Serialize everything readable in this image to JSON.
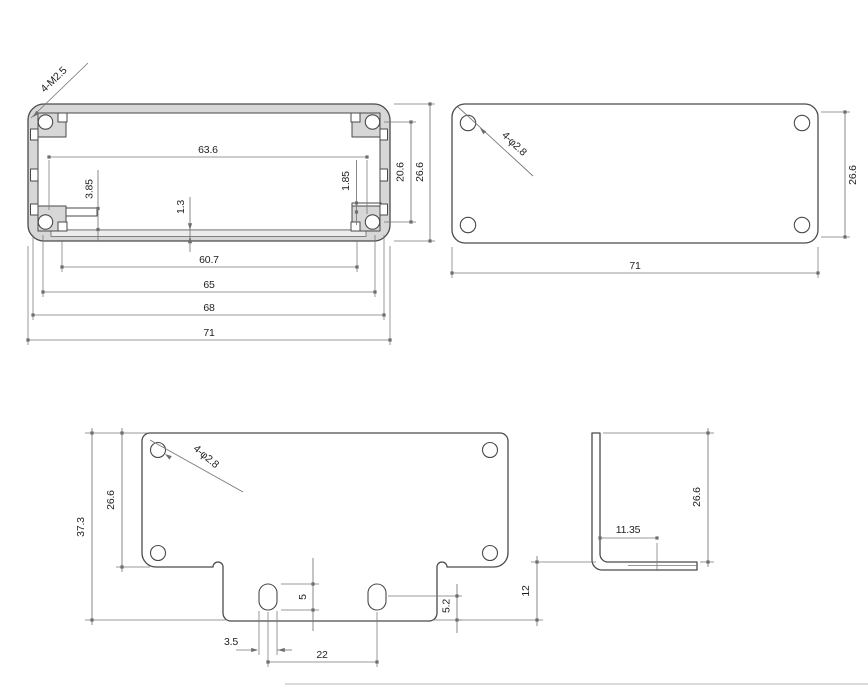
{
  "drawing": {
    "views": {
      "cross_section": {
        "label": "4-M2.5",
        "dims": {
          "inner_width": "63.6",
          "left_rib": "3.85",
          "groove_depth": "1.3",
          "right_rib": "1.85",
          "hole_pitch": "20.6",
          "overall_height": "26.6",
          "slot_span": "60.7",
          "inner_frame_width": "65",
          "boss_span": "68",
          "overall_width": "71"
        }
      },
      "end_plate": {
        "label": "4-φ2.8",
        "dims": {
          "height": "26.6",
          "width": "71"
        }
      },
      "flat_pattern": {
        "label": "4-φ2.8",
        "dims": {
          "overall_height": "37.3",
          "plate_height": "26.6",
          "slot_height": "5",
          "slot_to_edge": "5.2",
          "slot_width": "3.5",
          "slot_pitch": "22"
        }
      },
      "side_profile": {
        "dims": {
          "flange_length": "11.35",
          "height": "26.6",
          "tab_offset": "12"
        }
      }
    }
  }
}
